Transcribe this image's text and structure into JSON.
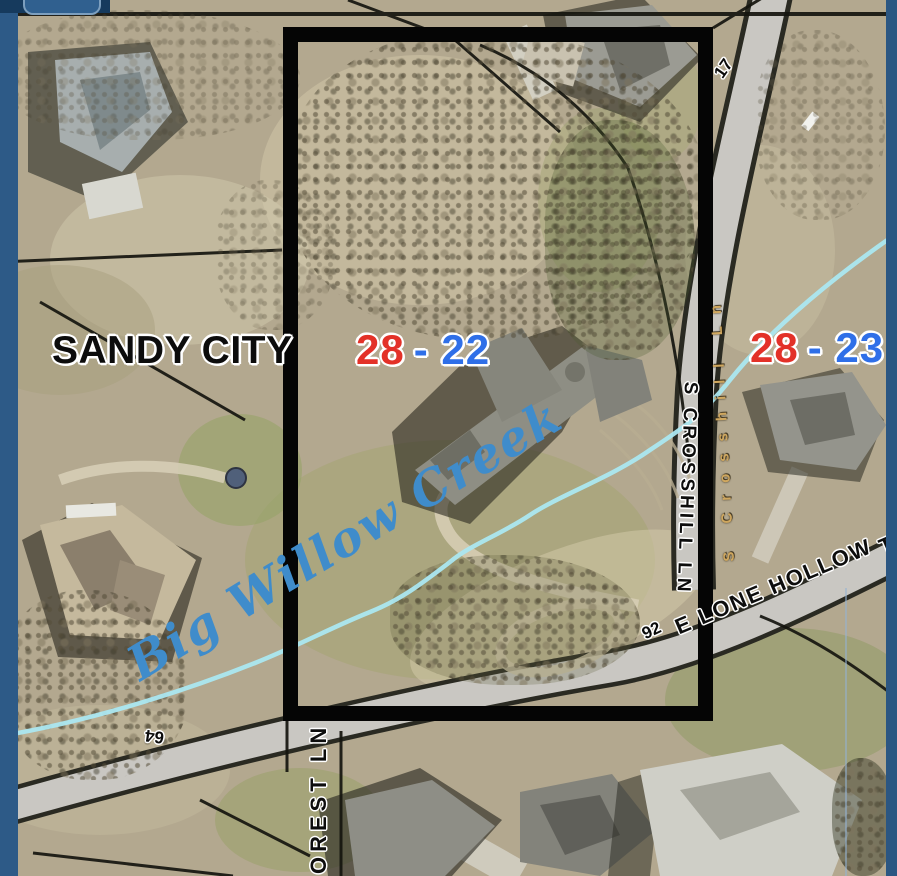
{
  "map": {
    "city_label": "SANDY CITY",
    "parcel_left": {
      "red": "28",
      "blue": "- 22"
    },
    "parcel_right": {
      "red": "28",
      "blue": "- 23"
    },
    "creek_label": "Big Willow Creek",
    "streets": {
      "crosshill_overlay": "S CROSSHILL LN",
      "crosshill_basemap": "S Crosshill Ln",
      "lone_hollow": "E LONE HOLLOW",
      "lone_hollow_partial": "T",
      "forest_partial": "OREST LN"
    },
    "markers": {
      "top_right": "17",
      "mid_right": "92",
      "bottom_left": "64"
    },
    "colors": {
      "frame_blue": "#2d5a87",
      "corner_navy": "#163a5d",
      "button_blue": "#30608f",
      "selection_outline": "#050505",
      "parcel_red": "#e33128",
      "parcel_blue": "#2f6fe8",
      "creek_line": "#abe7f0",
      "creek_text": "#3f8ccb",
      "basemap_street_text": "#cfa75f"
    }
  }
}
